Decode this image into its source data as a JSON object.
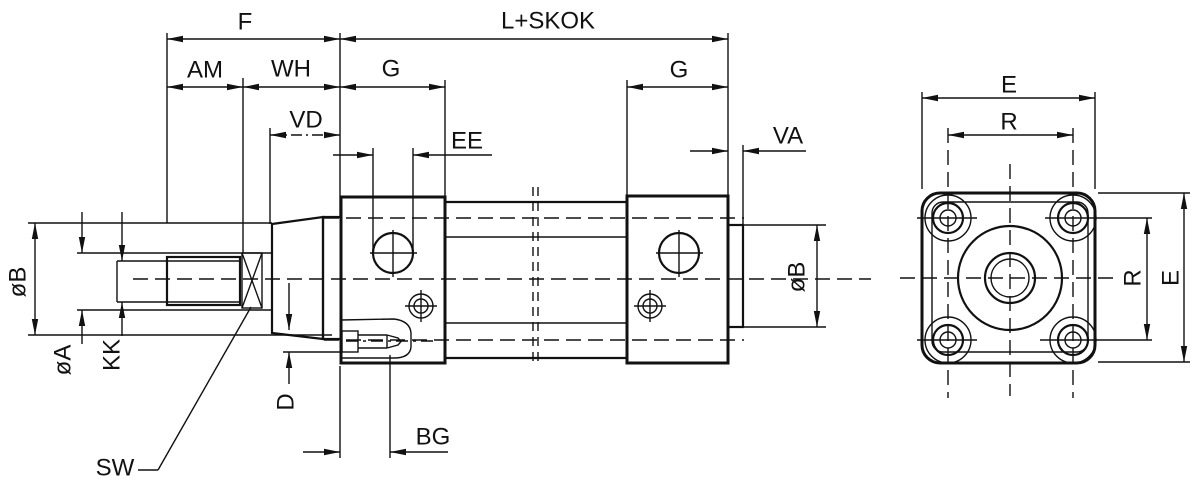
{
  "drawing": {
    "description": "Dimensional engineering drawing of a pneumatic cylinder: side section view with piston rod (left) and square rear-flange end view (right)",
    "colors": {
      "line": "#111111",
      "background": "#ffffff"
    },
    "labels": {
      "f": "F",
      "l_skok": "L+SKOK",
      "am": "AM",
      "wh": "WH",
      "vd": "VD",
      "ee": "EE",
      "g_left": "G",
      "g_right": "G",
      "va": "VA",
      "dia_b_left": "øB",
      "dia_a": "øA",
      "kk": "KK",
      "sw": "SW",
      "d": "D",
      "bg": "BG",
      "dia_b_right": "øB",
      "e_top": "E",
      "r_top": "R",
      "r_side": "R",
      "e_side": "E"
    }
  }
}
